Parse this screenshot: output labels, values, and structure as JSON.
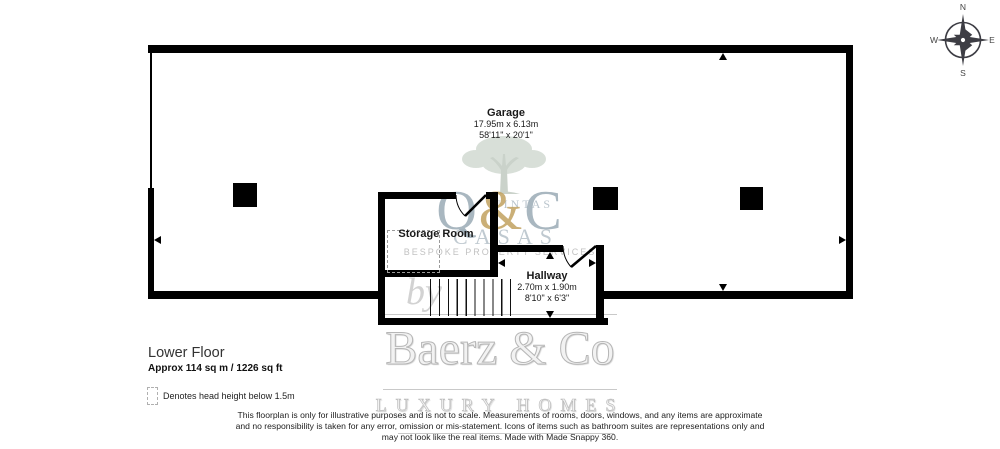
{
  "colors": {
    "wall": "#000000",
    "monogram_blue": "#94a4af",
    "monogram_gold": "#c1a15f",
    "watermark_gray": "#cccccc",
    "compass_ink": "#3d3d44"
  },
  "floor": {
    "title": "Lower Floor",
    "area": "Approx 114 sq m / 1226 sq ft"
  },
  "legend": {
    "note": "Denotes head height below 1.5m"
  },
  "rooms": {
    "garage": {
      "name": "Garage",
      "metric": "17.95m x 6.13m",
      "imperial": "58'11\" x 20'1\""
    },
    "storage": {
      "name": "Storage Room"
    },
    "hallway": {
      "name": "Hallway",
      "metric": "2.70m x 1.90m",
      "imperial": "8'10\" x 6'3\""
    }
  },
  "compass": {
    "n": "N",
    "e": "E",
    "s": "S",
    "w": "W"
  },
  "watermark": {
    "monogram_q": "Q",
    "monogram_amp": "&",
    "monogram_c": "C",
    "monogram_small": "UINTAS",
    "casas": "CASAS",
    "tagline": "BESPOKE PROPERTY SERVICES",
    "by": "by",
    "brand": "Baerz & Co",
    "brand_tagline": "LUXURY HOMES"
  },
  "disclaimer": {
    "line1": "This floorplan is only for illustrative purposes and is not to scale. Measurements of rooms, doors, windows, and any items are approximate",
    "line2": "and no responsibility is taken for any error, omission or mis-statement. Icons of items such as bathroom suites are representations only and",
    "line3": "may not look like the real items. Made with Made Snappy 360."
  }
}
